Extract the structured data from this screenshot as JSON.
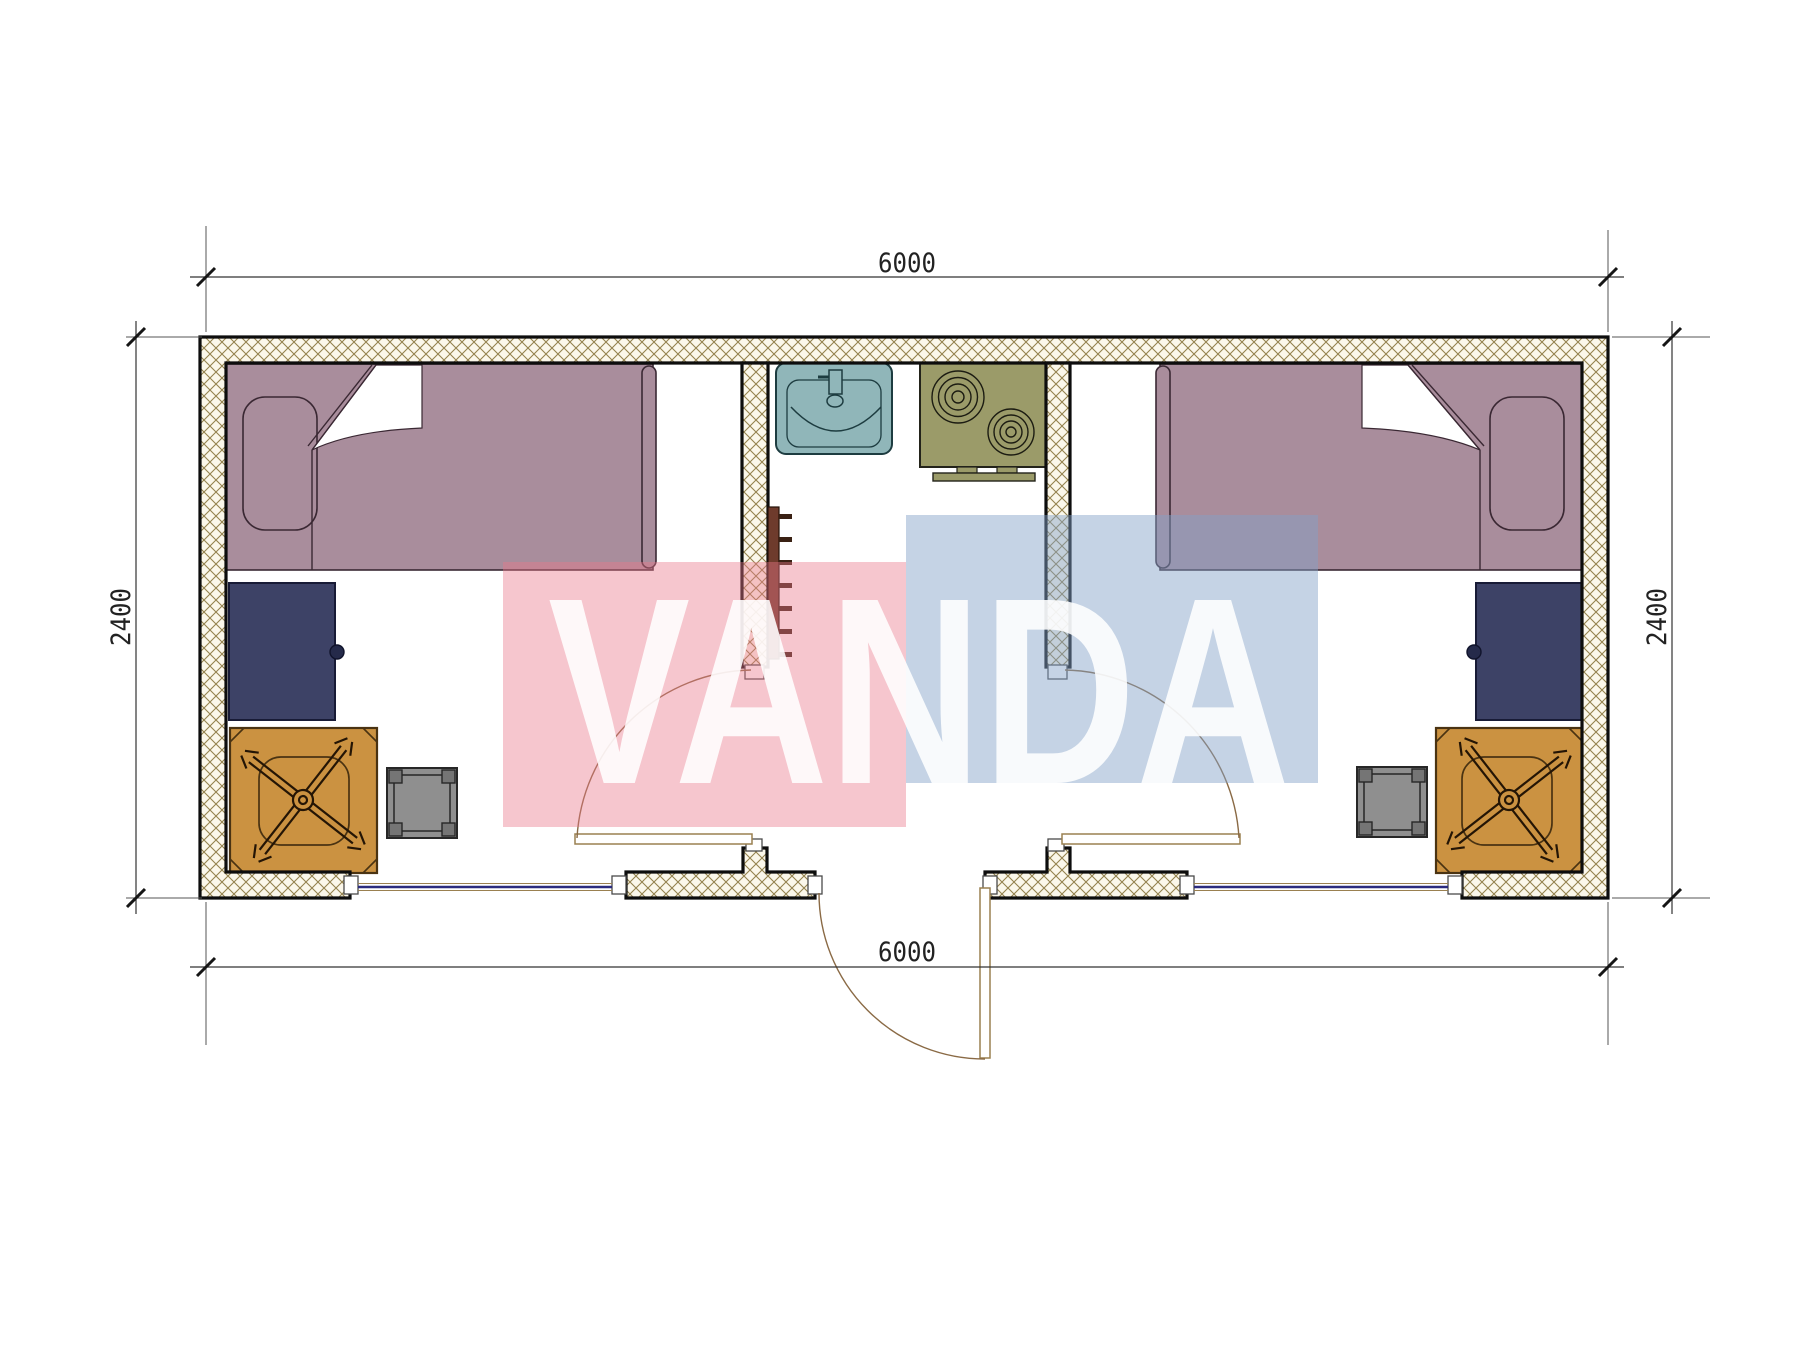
{
  "plan": {
    "dimensions": {
      "top": "6000",
      "bottom": "6000",
      "left": "2400",
      "right": "2400"
    },
    "watermark": {
      "text": "VANDA",
      "pink": "rgba(234,119,138,0.42)",
      "blue": "rgba(132,161,200,0.47)",
      "letter": "rgba(255,255,255,0.88)"
    },
    "colors": {
      "hatch_line": "#94824e",
      "hatch_bg": "#fbf7ea",
      "wall_stroke": "#0d0d0d",
      "bed": "#a98d9c",
      "bed_stroke": "#3a2833",
      "desk": "#3d4266",
      "desk_stroke": "#181b36",
      "knob": "#252a4a",
      "chair": "#cb9241",
      "chair_stroke": "#4a3312",
      "stool": "#8f8f8f",
      "stool_leg": "#757575",
      "stool_stroke": "#272727",
      "sink": "#90b6b9",
      "sink_stroke": "#1d3c40",
      "stove": "#9b9b69",
      "stove_stroke": "#23231a",
      "ladder": "#6e3b2c",
      "ladder_rung": "#3a2114",
      "window_line": "#2b2b7e",
      "opening_edge": "#9a8050",
      "door_leaf": "#9a8050",
      "door_arc": "#8a6a45",
      "jamb_stroke": "#4a4a4a",
      "dim_line": "#333333",
      "ext_line": "#555555",
      "tick": "#151515",
      "dim_text": "#222222"
    }
  }
}
